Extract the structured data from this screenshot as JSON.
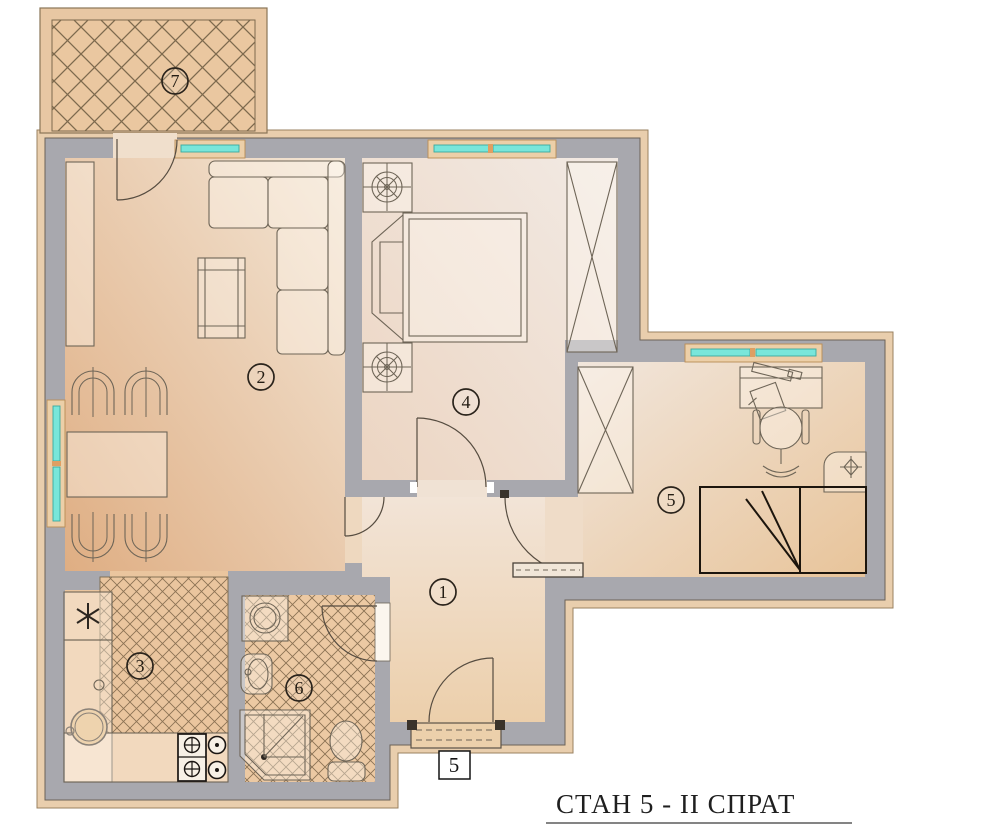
{
  "title": {
    "text": "СТАН 5 -  II СПРАТ"
  },
  "entrance": {
    "unit_label": "5"
  },
  "rooms": [
    {
      "number": "1"
    },
    {
      "number": "2"
    },
    {
      "number": "3"
    },
    {
      "number": "4"
    },
    {
      "number": "5"
    },
    {
      "number": "6"
    },
    {
      "number": "7"
    }
  ],
  "colors": {
    "wall": "#a8a8ae",
    "exterior_trim": "#e9cead",
    "window_glass": "#79e6da",
    "floor_tan": "#eac59e",
    "hatch_line": "#8b7254",
    "detail_black": "#20180f"
  }
}
